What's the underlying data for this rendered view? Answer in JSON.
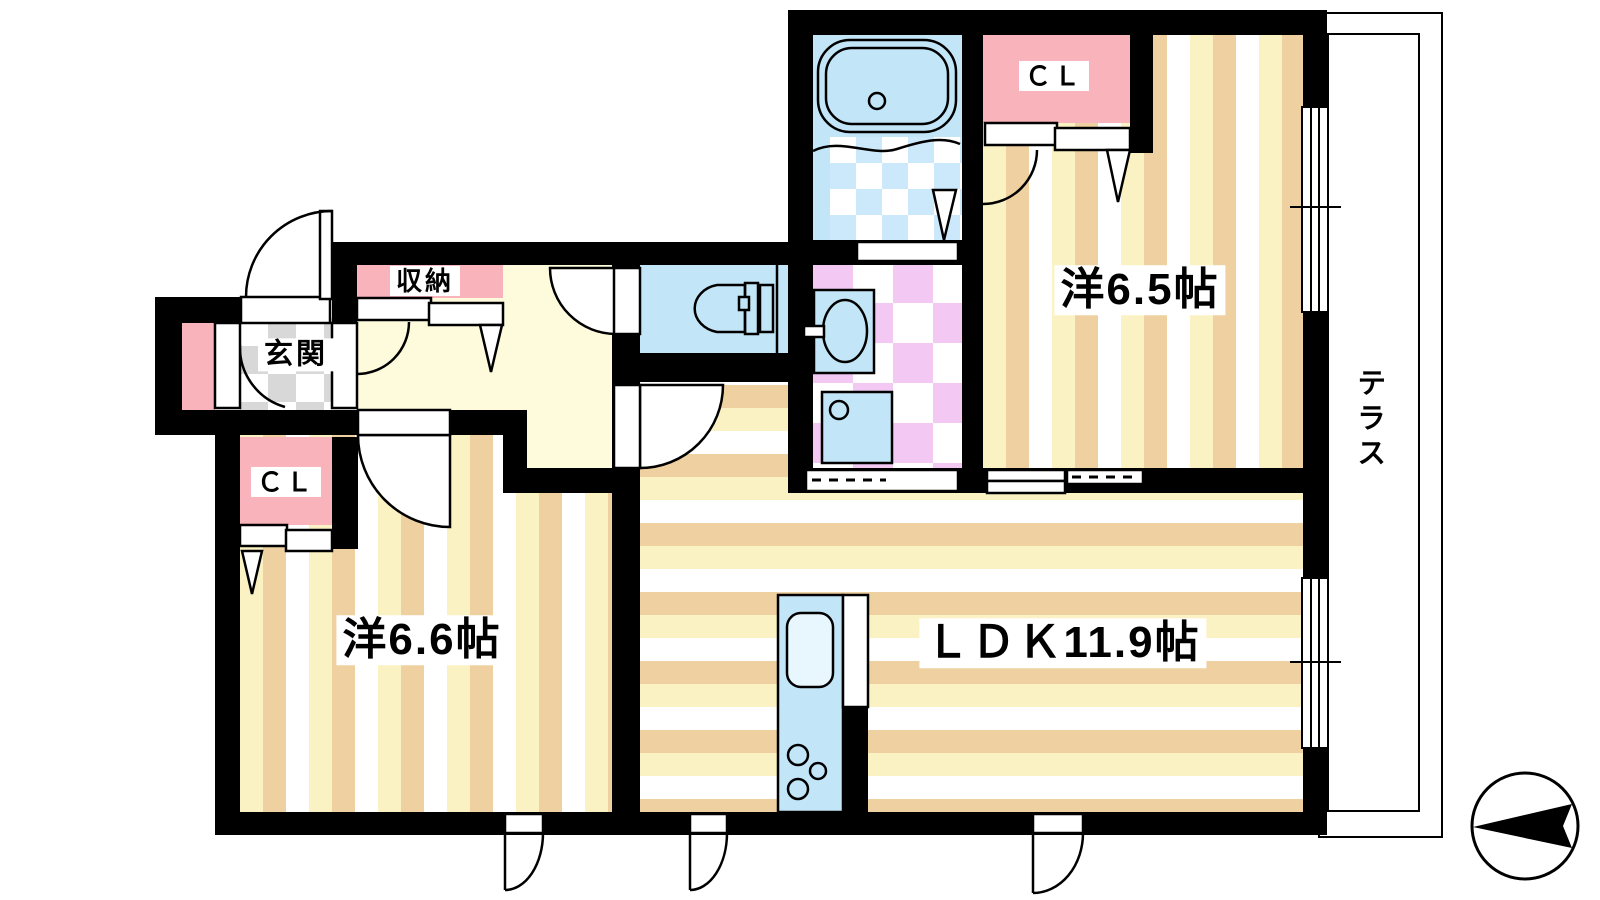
{
  "title": "apartment-floor-plan",
  "rooms": {
    "entrance": {
      "label": "玄関"
    },
    "storage": {
      "label": "収納"
    },
    "closet_west66": {
      "label": "ＣＬ"
    },
    "closet_west65": {
      "label": "ＣＬ"
    },
    "western_room_65": {
      "label": "洋6.5帖"
    },
    "western_room_66": {
      "label": "洋6.6帖"
    },
    "ldk": {
      "label": "ＬＤＫ11.9帖"
    },
    "terrace": {
      "label": "テラス"
    }
  },
  "icons": {
    "compass": "north-arrow-icon",
    "fixtures": [
      "bathtub-icon",
      "toilet-icon",
      "washbasin-icon",
      "washing-machine-icon",
      "kitchen-sink-icon",
      "stove-burners-icon"
    ]
  },
  "colors": {
    "wall": "#000000",
    "floor_stripe_tan": "#efd0a0",
    "floor_stripe_yellow": "#fbf2c4",
    "hallway_floor": "#fefadc",
    "closet_pink": "#f8b3bb",
    "plumbing_blue": "#c2e6f8",
    "bath_tile": "#cbe9fb",
    "washroom_tile": "#f3c9f3",
    "terrace_green": "#cbf6c6",
    "entrance_tile": "#d8d8d8"
  }
}
